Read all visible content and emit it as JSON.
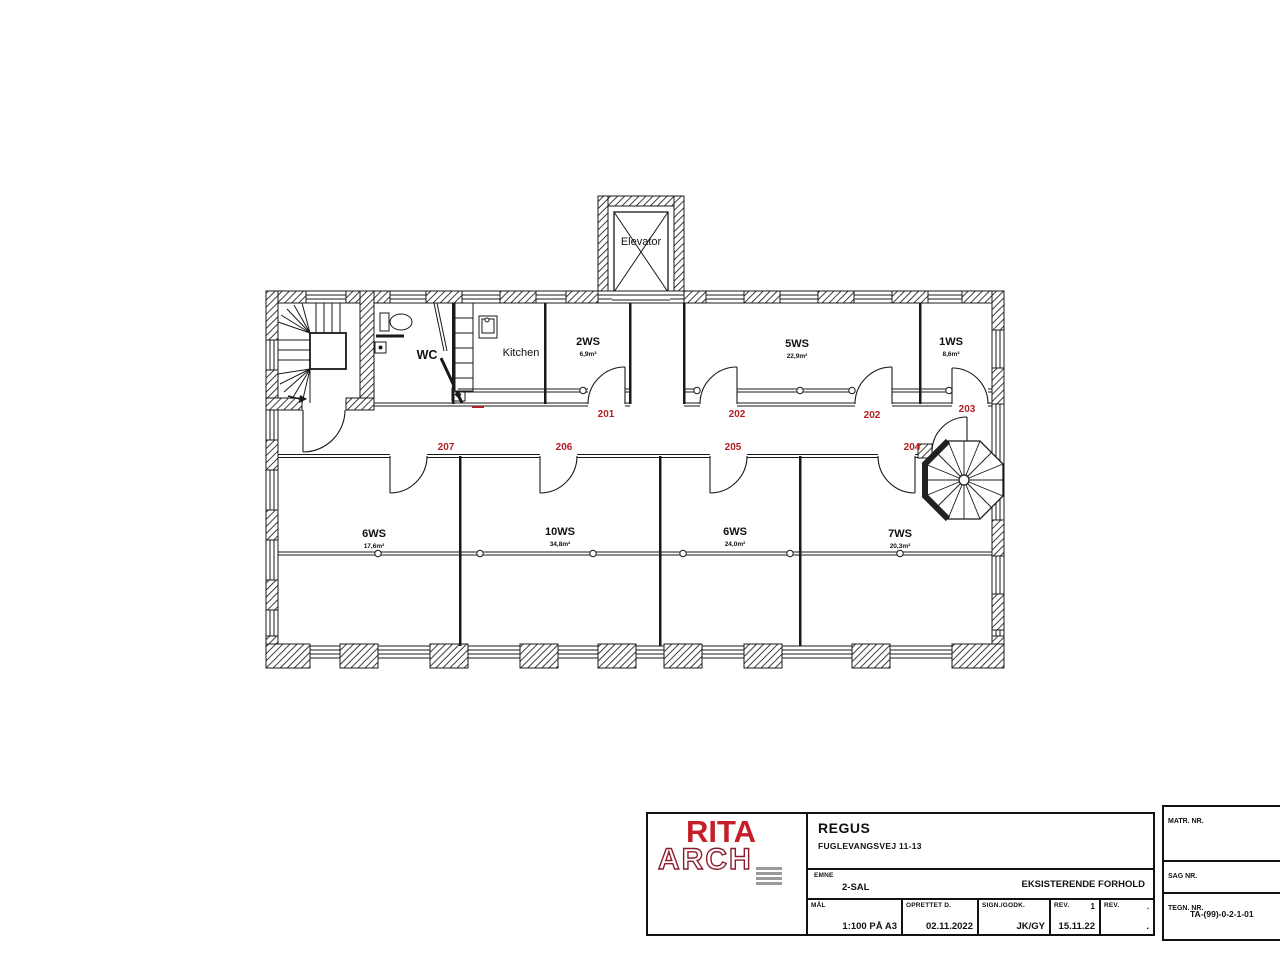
{
  "drawing": {
    "labels": {
      "elevator": "Elevator",
      "wc": "WC",
      "kitchen": "Kitchen"
    },
    "rooms": [
      {
        "name": "2WS",
        "area": "6,9m²"
      },
      {
        "name": "5WS",
        "area": "22,9m²"
      },
      {
        "name": "1WS",
        "area": "8,6m²"
      },
      {
        "name": "6WS",
        "area": "17,6m²"
      },
      {
        "name": "10WS",
        "area": "34,8m²"
      },
      {
        "name": "6WS",
        "area": "24,0m²"
      },
      {
        "name": "7WS",
        "area": "20,3m²"
      }
    ],
    "door_numbers": [
      "201",
      "202",
      "202",
      "203",
      "204",
      "205",
      "206",
      "207"
    ],
    "accent_red": "#b32025"
  },
  "title_block": {
    "logo_line1": "RITA",
    "logo_line2": "ARCH",
    "logo_red": "#c5202a",
    "client": "REGUS",
    "address": "FUGLEVANGSVEJ 11-13",
    "emne_label": "EMNE",
    "emne_value": "2-SAL",
    "status": "EKSISTERENDE FORHOLD",
    "maal_label": "MÅL",
    "maal_value": "1:100 PÅ A3",
    "oprettet_label": "OPRETTET D.",
    "oprettet_value": "02.11.2022",
    "sign_label": "SIGN./GODK.",
    "sign_value": "JK/GY",
    "rev1_label": "REV.",
    "rev1_no": "1",
    "rev1_value": "15.11.22",
    "rev2_label": "REV.",
    "rev2_no": ".",
    "rev2_value": "."
  },
  "side_block": {
    "matr_label": "MATR. NR.",
    "sag_label": "SAG NR.",
    "tegn_label": "TEGN. NR.",
    "tegn_value": "TA-(99)-0-2-1-01"
  }
}
